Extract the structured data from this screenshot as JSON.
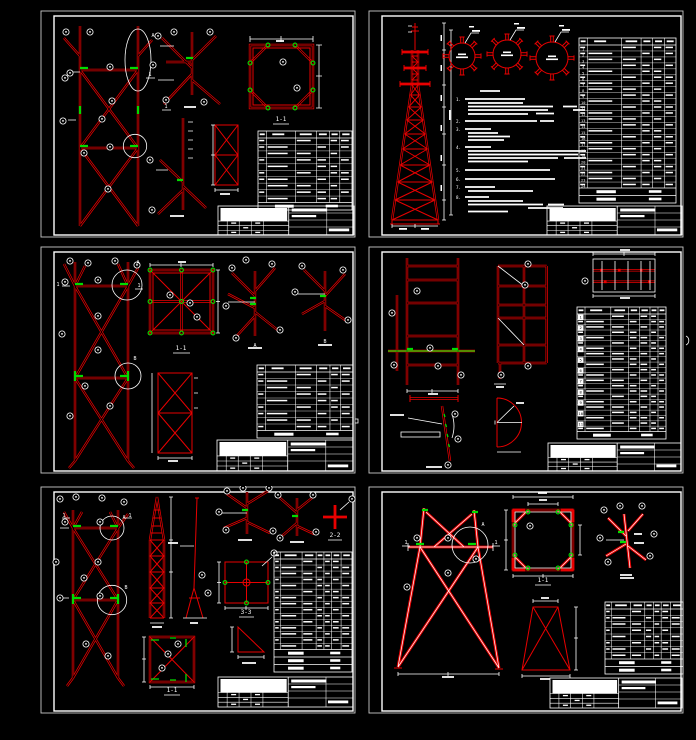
{
  "app": {
    "description": "CAD drawing set - lattice steel tower fabrication sheets",
    "background": "#000000"
  },
  "colors": {
    "red": "#e80000",
    "green": "#00dc00",
    "white": "#ffffff"
  },
  "sheet1": {
    "plan_label": "1-1",
    "detail_label": "A",
    "section_mark": "1"
  },
  "sheet2": {
    "note_numbers": [
      "1.",
      "2.",
      "3.",
      "4.",
      "5.",
      "6.",
      "7.",
      "8."
    ],
    "table_row_numbers": [
      "1",
      "2",
      "3",
      "4",
      "5",
      "6",
      "7",
      "8",
      "9",
      "10",
      "11",
      "12",
      "13",
      "14",
      "15",
      "16",
      "17",
      "18",
      "19",
      "20",
      "21",
      "22",
      "23",
      "24"
    ]
  },
  "sheet3": {
    "plan_label": "1-1",
    "detail_a_label": "A",
    "detail_b_label": "B",
    "section_mark": "1"
  },
  "sheet4": {
    "table_row_numbers": [
      "1",
      "2",
      "3",
      "4",
      "5",
      "6",
      "7",
      "8",
      "9",
      "10",
      "11"
    ]
  },
  "sheet5": {
    "plan_label": "1-1",
    "cross_section_label": "2-2",
    "plate_section_label": "3-3",
    "detail_a_label": "A",
    "detail_b_label": "B",
    "section_mark": "1"
  },
  "sheet6": {
    "plan_label": "1-1",
    "detail_label": "A",
    "section_mark": "1"
  }
}
